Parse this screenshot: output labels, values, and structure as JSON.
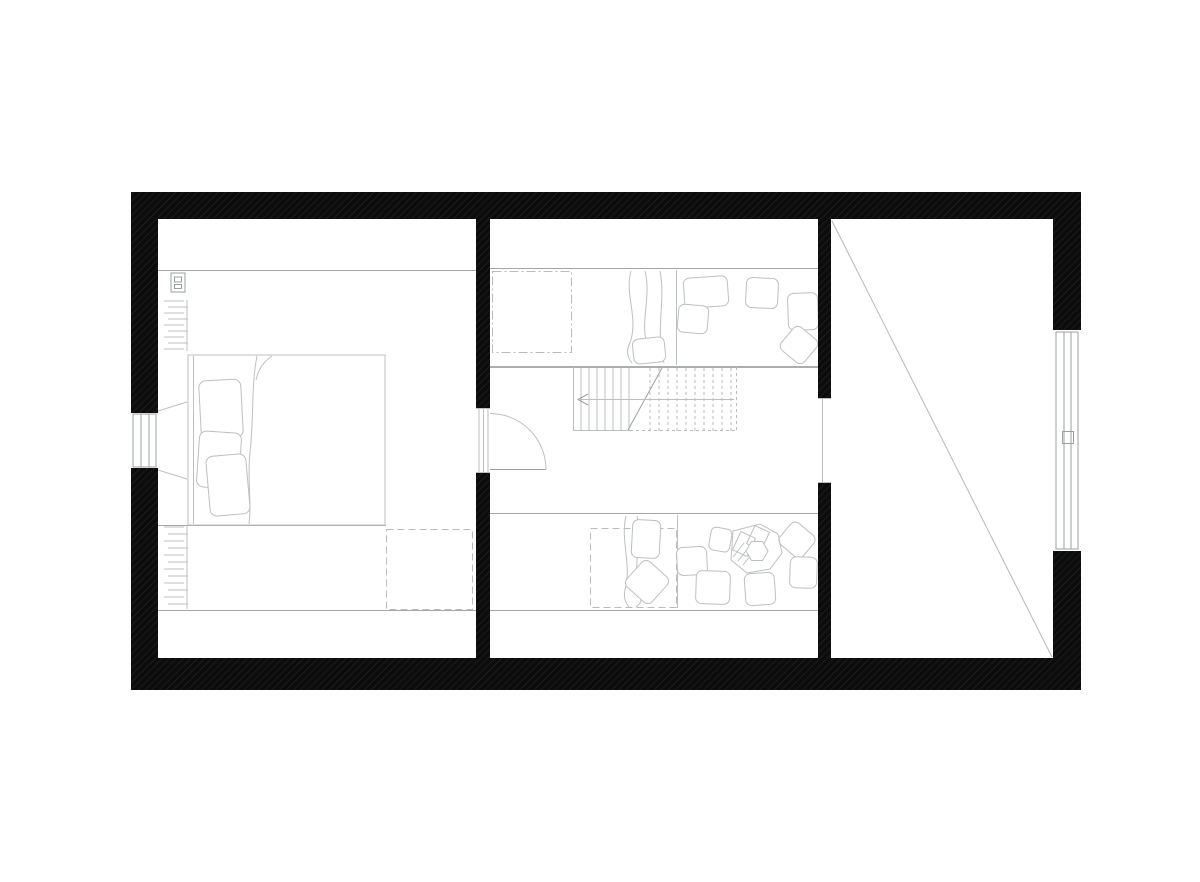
{
  "drawing": {
    "kind": "architectural-floor-plan",
    "view": "top-down attic level, black hatched walls, light-gray line work, no text labels",
    "features": [
      "bedroom-with-double-bed",
      "wall-radiator-upper",
      "wall-radiator-lower",
      "electrical-panel",
      "skylight-dashed-bedroom",
      "interior-door-with-swing-arc",
      "central-hall-with-staircase",
      "stair-direction-arrow",
      "built-in-daybed-top-with-pillows",
      "built-in-daybed-bottom-with-pillows",
      "person-sitting-with-book",
      "skylight-dashdot-hall",
      "skylight-dashed-hall",
      "open-void-room-with-diagonal",
      "window-left-wall",
      "window-right-wall",
      "wall-opening-to-void-room"
    ]
  },
  "colors": {
    "background": "#ffffff",
    "wall_fill": "#0c0c0c",
    "wall_hatch": "#262626",
    "furniture_line": "#bcc1bf",
    "floor_line": "#a3a8a6",
    "platform_edge": "#8e9391",
    "detail_line": "#9aa09e",
    "dashed_line": "#b8bdbb",
    "void_diagonal": "#b4b9b7"
  }
}
